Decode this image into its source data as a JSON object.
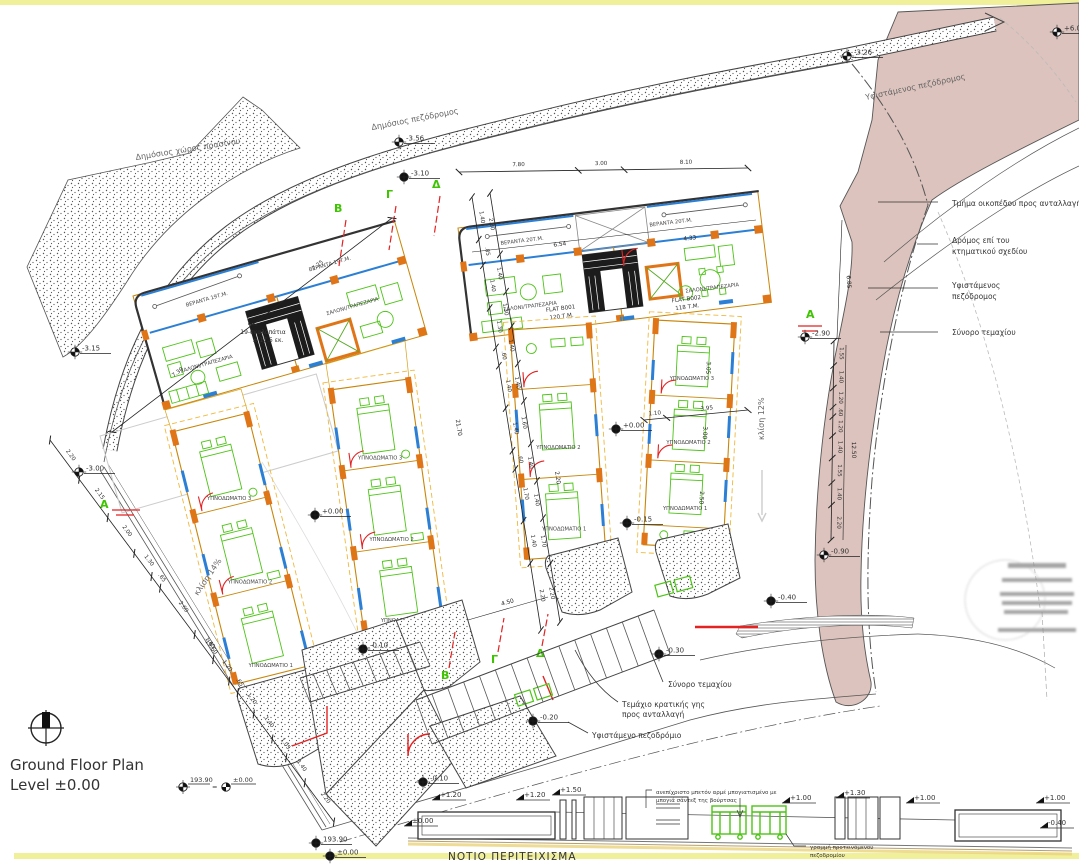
{
  "title": {
    "line1": "Ground Floor Plan",
    "line2": "Level ±0.00"
  },
  "area_labels": {
    "public_green": "Δημόσιος χώρος πρασίνου",
    "public_walkway": "Δημόσιος πεζόδρομος",
    "existing_walkway_area": "Υφιστάμενος πεζόδρομος",
    "slope12": "κλίση 12%",
    "slope14": "κλίση 14%",
    "steps1": "19-σκαλοπάτια",
    "steps2": "± 17.5 εκ."
  },
  "leaders_right": [
    {
      "lines": [
        "Τμήμα οικοπέδου προς ανταλλαγή"
      ]
    },
    {
      "lines": [
        "Δρόμος επί του",
        "κτηματικού σχεδίου"
      ]
    },
    {
      "lines": [
        "Υφιστάμενος",
        "πεζόδρομος"
      ]
    },
    {
      "lines": [
        "Σύνορο τεμαχίου"
      ]
    }
  ],
  "leaders_bottom": [
    {
      "lines": [
        "Σύνορο τεμαχίου"
      ]
    },
    {
      "lines": [
        "Τεμάχιο κρατικής γης",
        "προς ανταλλαγή"
      ]
    },
    {
      "lines": [
        "Υφιστάμενο πεζοδρόμιο"
      ]
    }
  ],
  "flats": {
    "a001": {
      "name": "FLAT A001",
      "area": "116 Τ.Μ."
    },
    "a002": {
      "name": "FLAT A002",
      "area": "107 Τ.Μ."
    },
    "b001": {
      "name": "FLAT B001",
      "area": "120 Τ.Μ."
    },
    "b002": {
      "name": "FLAT B002",
      "area": "118 Τ.Μ."
    }
  },
  "rooms": {
    "living": "ΣΑΛΟΝΙ/ΤΡΑΠΕΖΑΡΙΑ",
    "veranda_a": "ΒΕΡΑΝΤΑ 19Τ.Μ.",
    "veranda_b": "ΒΕΡΑΝΤΑ 20Τ.Μ.",
    "bed1": "ΥΠΝΟΔΩΜΑΤΙΟ 1",
    "bed2": "ΥΠΝΟΔΩΜΑΤΙΟ 2",
    "bed3": "ΥΠΝΟΔΩΜΑΤΙΟ 3"
  },
  "section_letters": {
    "a": "Α",
    "b": "Β",
    "g": "Γ",
    "d": "Δ"
  },
  "benchmark": {
    "left": "193.90",
    "eq": "=",
    "right": "±0.00"
  },
  "south_section": {
    "title": "ΝΟΤΙΟ ΠΕΡΙΤΕΙΧΙΣΜΑ",
    "note_concrete": [
      "ανεπίχριστο μπετόν αρμέ μπογιατισμένο με",
      "μπογιά σάντεξ της βούρτσας"
    ],
    "note_sidewalk": [
      "γραμμή προτεινόμενου",
      "πεζοδρομίου"
    ]
  },
  "dims": {
    "t1250": "12.50",
    "t685": "6.85",
    "t2170": "21.70",
    "t1960": "19.60",
    "t450": "4.50",
    "t220": "2.20",
    "d654": "6.54",
    "d433": "4.33",
    "d305": "3.05",
    "d300": "3.00",
    "d250": "2.50"
  },
  "markers": [
    {
      "v": "+6.00",
      "x": 1057,
      "y": 32,
      "t": "o"
    },
    {
      "v": "-3.26",
      "x": 847,
      "y": 56,
      "t": "o"
    },
    {
      "v": "-3.56",
      "x": 399,
      "y": 142,
      "t": "o"
    },
    {
      "v": "-3.10",
      "x": 404,
      "y": 177,
      "t": "f"
    },
    {
      "v": "-3.15",
      "x": 75,
      "y": 352,
      "t": "o"
    },
    {
      "v": "-3.00",
      "x": 79,
      "y": 472,
      "t": "o"
    },
    {
      "v": "-2.90",
      "x": 805,
      "y": 337,
      "t": "o"
    },
    {
      "v": "-0.90",
      "x": 824,
      "y": 555,
      "t": "o"
    },
    {
      "v": "+0.00",
      "x": 315,
      "y": 515,
      "t": "f"
    },
    {
      "v": "+0.00",
      "x": 616,
      "y": 429,
      "t": "f"
    },
    {
      "v": "-0.15",
      "x": 627,
      "y": 523,
      "t": "f"
    },
    {
      "v": "-0.10",
      "x": 363,
      "y": 649,
      "t": "f"
    },
    {
      "v": "-0.10",
      "x": 423,
      "y": 782,
      "t": "f"
    },
    {
      "v": "-0.20",
      "x": 533,
      "y": 721,
      "t": "f"
    },
    {
      "v": "-0.30",
      "x": 659,
      "y": 654,
      "t": "f"
    },
    {
      "v": "-0.40",
      "x": 771,
      "y": 601,
      "t": "f"
    },
    {
      "v": "193.90",
      "x": 316,
      "y": 843,
      "t": "f"
    },
    {
      "v": "±0.00",
      "x": 330,
      "y": 856,
      "t": "f"
    },
    {
      "v": "±0.00",
      "x": 404,
      "y": 824,
      "t": "flag"
    },
    {
      "v": "+1.20",
      "x": 432,
      "y": 798,
      "t": "flag"
    },
    {
      "v": "+1.20",
      "x": 516,
      "y": 798,
      "t": "flag"
    },
    {
      "v": "+1.50",
      "x": 552,
      "y": 793,
      "t": "flag"
    },
    {
      "v": "+1.00",
      "x": 782,
      "y": 801,
      "t": "flag"
    },
    {
      "v": "+1.30",
      "x": 836,
      "y": 796,
      "t": "flag"
    },
    {
      "v": "+1.00",
      "x": 906,
      "y": 801,
      "t": "flag"
    },
    {
      "v": "+1.00",
      "x": 1036,
      "y": 801,
      "t": "flag"
    },
    {
      "v": "-0.40",
      "x": 1040,
      "y": 826,
      "t": "flag"
    }
  ],
  "chains": [
    {
      "x1": 459,
      "y1": 172,
      "x2": 748,
      "y2": 168,
      "off": -5,
      "labels": [
        "7.80",
        "3.00",
        "8.10"
      ]
    },
    {
      "x1": 50,
      "y1": 440,
      "x2": 334,
      "y2": 822,
      "off": -6,
      "labels": [
        "2.20",
        "2.15",
        "2.00",
        "1.30",
        ".65",
        "2.60",
        "1.40",
        "1.20",
        ".65",
        "1.20",
        "1.40",
        "1.05",
        "1.40",
        "2.20"
      ]
    },
    {
      "x1": 834,
      "y1": 341,
      "x2": 831,
      "y2": 540,
      "off": -6,
      "labels": [
        "1.55",
        "1.40",
        "1.20",
        ".60",
        "1.20",
        "1.40",
        "1.55",
        "1.40",
        "2.20"
      ]
    },
    {
      "x1": 472,
      "y1": 197,
      "x2": 541,
      "y2": 630,
      "off": -5,
      "labels": [
        "1.40",
        ".85",
        "1.40",
        "1.30",
        ".60",
        "1.40",
        "1.40",
        ".60",
        "1.70",
        "1.40",
        "2.20"
      ]
    },
    {
      "x1": 490,
      "y1": 193,
      "x2": 560,
      "y2": 622,
      "off": 5,
      "labels": [
        "2.30",
        "1.40",
        "1.30",
        "1.40",
        "1.40",
        "1.60",
        "1.40",
        "1.40",
        "1.70",
        "2.20"
      ]
    },
    {
      "x1": 112,
      "y1": 432,
      "x2": 392,
      "y2": 218,
      "off": -6,
      "labels": [
        "7.30",
        "7.25"
      ]
    },
    {
      "x1": 644,
      "y1": 420,
      "x2": 748,
      "y2": 410,
      "off": -4,
      "labels": [
        "1.10",
        "3.95"
      ]
    }
  ],
  "step_bands": [
    {
      "x1": 416,
      "y1": 700,
      "x2": 654,
      "y2": 610,
      "x3": 432,
      "y3": 744,
      "x4": 670,
      "y4": 654,
      "n": 15
    },
    {
      "x1": 300,
      "y1": 678,
      "x2": 420,
      "y2": 642,
      "x3": 310,
      "y3": 702,
      "x4": 430,
      "y4": 666,
      "n": 9
    }
  ]
}
